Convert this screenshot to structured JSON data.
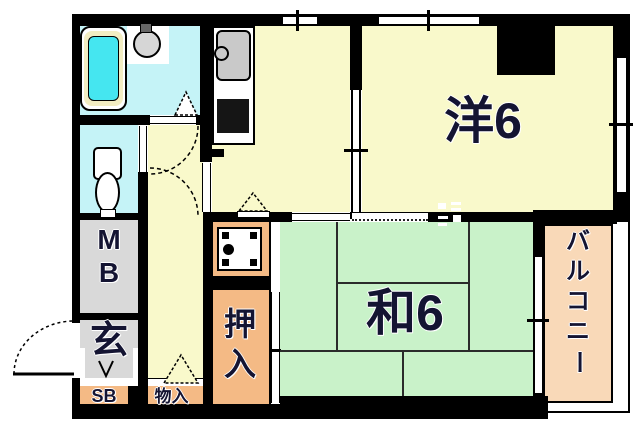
{
  "plan_type": "apartment-floorplan",
  "rooms": {
    "western": {
      "label": "洋6"
    },
    "japanese": {
      "label": "和6"
    },
    "balcony": {
      "chars": [
        "バ",
        "ル",
        "コ",
        "ニ",
        "ー"
      ]
    },
    "closet": {
      "chars": [
        "押",
        "入"
      ]
    },
    "meter_box": {
      "chars": [
        "M",
        "B"
      ]
    },
    "entrance": {
      "label": "玄"
    },
    "shoe_box": {
      "label": "SB"
    },
    "storage": {
      "label": "物入"
    }
  },
  "colors": {
    "wall": "#000000",
    "wet_room": "#c5f3f7",
    "room_yellow": "#f9f9cb",
    "tatami_green": "#c9f2c9",
    "closet_orange": "#f4ba85",
    "balcony_orange": "#f9d9b8",
    "utility_gray": "#d9d9d9",
    "tub_water": "#45e6f0"
  }
}
